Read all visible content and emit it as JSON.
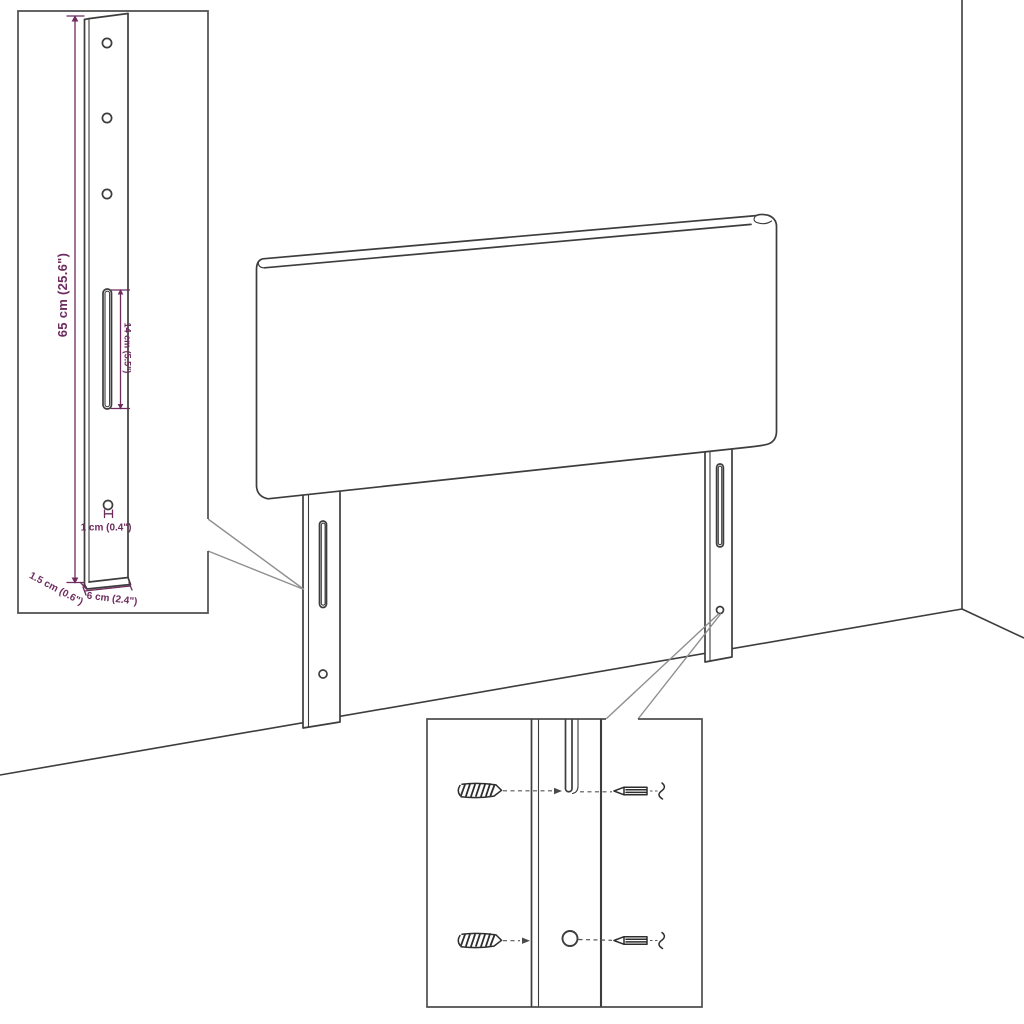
{
  "colors": {
    "line": "#3d3d3d",
    "border": "#4f4f4f",
    "callout": "#8f8f8f",
    "dimension": "#6e2b5e",
    "screw": "#2e2e2e",
    "background": "#ffffff"
  },
  "left_inset": {
    "labels": {
      "height": "65 cm (25.6\")",
      "slot": "14 cm (5.5\")",
      "hole": "1 cm (0.4\")",
      "depth": "1.5 cm (0.6\")",
      "width": "6 cm (2.4\")"
    }
  }
}
